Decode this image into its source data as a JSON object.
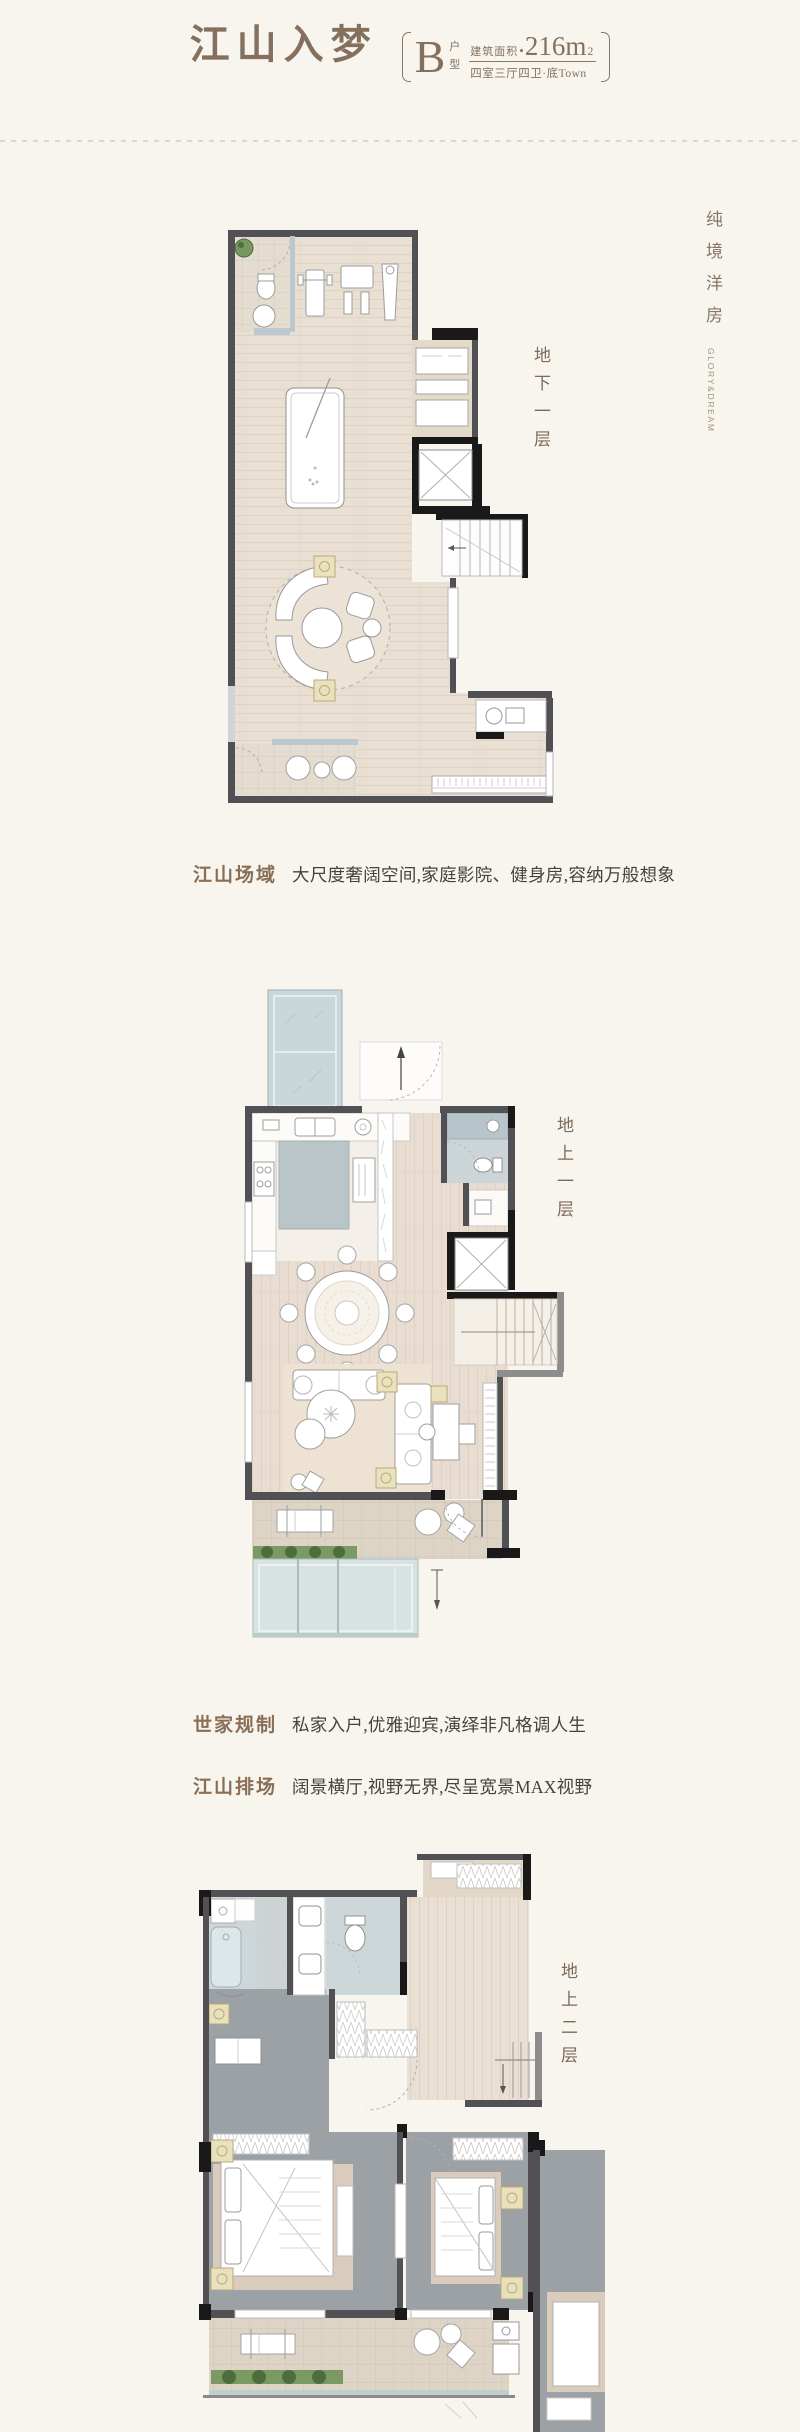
{
  "header": {
    "title": "江山入梦",
    "unit": {
      "letter": "B",
      "label_top": "户",
      "label_bottom": "型"
    },
    "area_label": "建筑面积",
    "area_bullet": "•",
    "area_value": "216m",
    "area_sup": "2",
    "spec": "四室三厅四卫·底Town"
  },
  "side_banner": {
    "cn": "纯境洋房",
    "en": "GLORY&DREAM"
  },
  "floor_labels": {
    "basement": "地下一层",
    "first": "地上一层",
    "second": "地上二层"
  },
  "captions": [
    {
      "title": "江山场域",
      "text": "大尺度奢阔空间,家庭影院、健身房,容纳万般想象"
    },
    {
      "title": "世家规制",
      "text": "私家入户,优雅迎宾,演绎非凡格调人生"
    },
    {
      "title": "江山排场",
      "text": "阔景横厅,视野无界,尽呈宽景MAX视野"
    }
  ],
  "stair_marker": "下",
  "colors": {
    "page_bg": "#f8f5ef",
    "brand": "#85705e",
    "text_dark": "#45423f"
  }
}
